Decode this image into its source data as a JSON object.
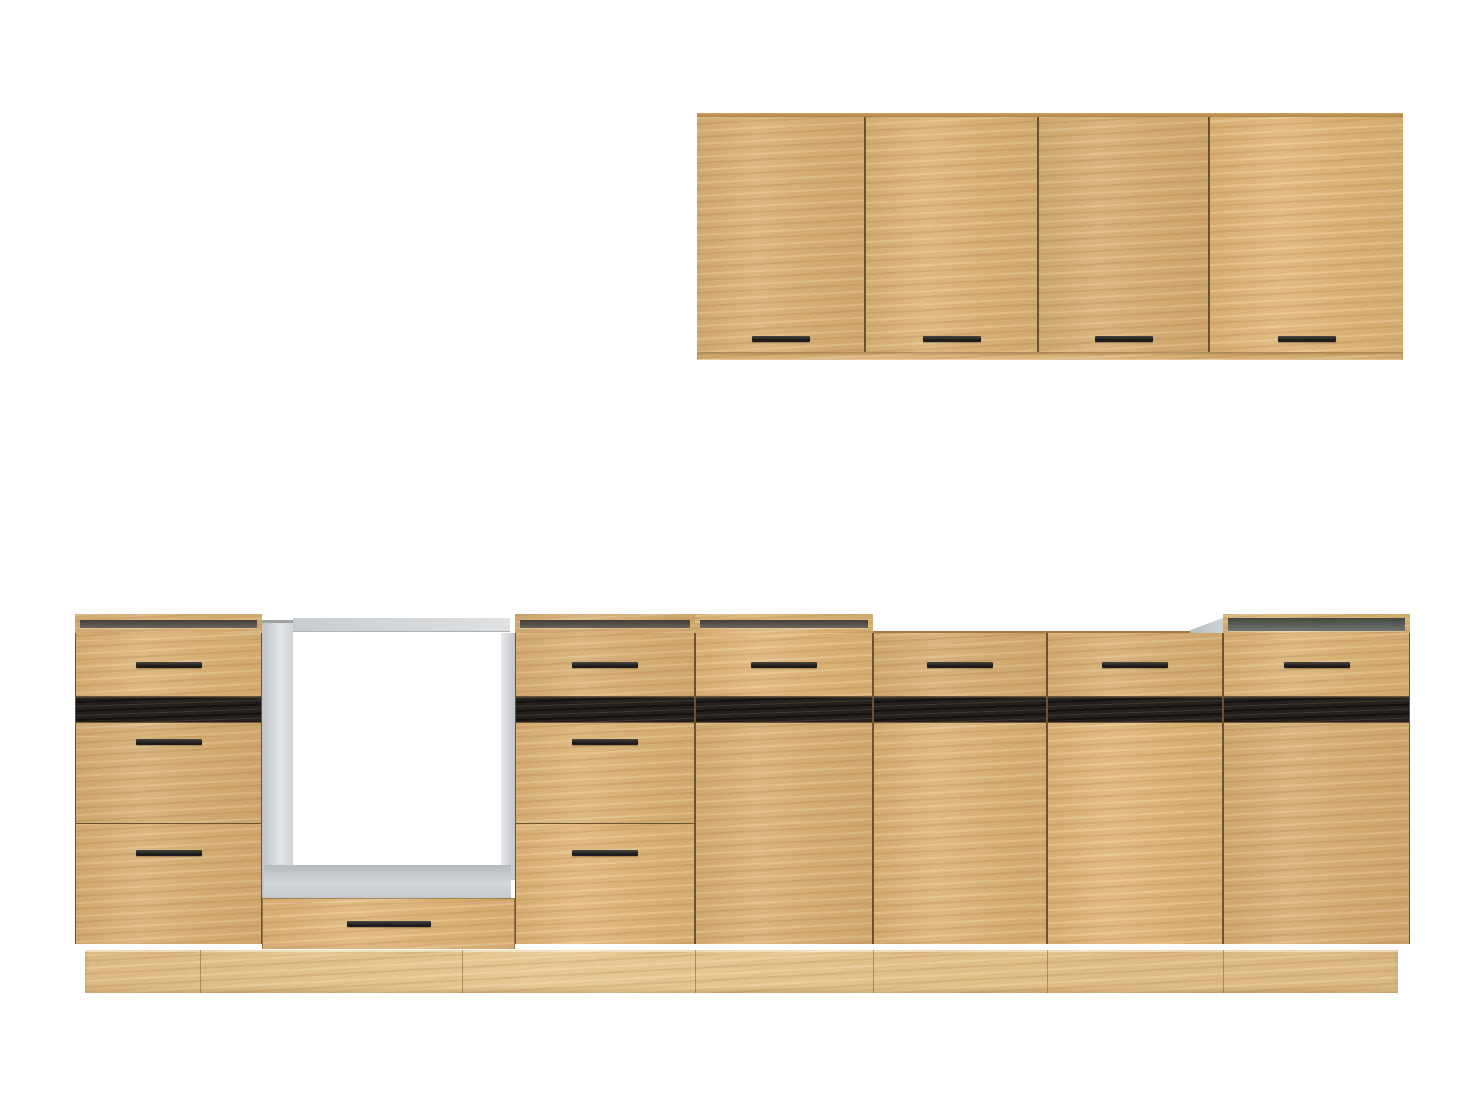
{
  "meta": {
    "type": "product-photo",
    "subject": "Modular kitchen cabinet set in natural oak with black accent strips and black bar handles, shown without countertop on a plain white background",
    "background_color": "#ffffff"
  },
  "colors": {
    "background": "#ffffff",
    "wood": "#d8b177",
    "wood_light": "#e8cb97",
    "wood_dark": "#b78d55",
    "gap": "#6b5330",
    "accent_strip": "#24211d",
    "handle": "#1d1c1a",
    "carcass_grey": "#d6d8da",
    "carcass_grey_dark": "#a7abae",
    "interior_slot": "#433e36",
    "plinth": "#debe8a"
  },
  "wall_cabinet": {
    "door_count": 4,
    "handle_style": "black horizontal bar near bottom center of each door"
  },
  "base_run": {
    "units": [
      {
        "name": "drawer-unit-left",
        "open_top": true,
        "fronts": [
          "drawer",
          "accent-strip",
          "drawer",
          "drawer"
        ],
        "handles": 3
      },
      {
        "name": "oven-housing",
        "open_top": true,
        "fronts": [
          "open cavity",
          "bottom drawer"
        ],
        "handles": 1
      },
      {
        "name": "drawer-unit-middle",
        "open_top": true,
        "fronts": [
          "drawer",
          "accent-strip",
          "drawer",
          "drawer"
        ],
        "handles": 3
      },
      {
        "name": "door-unit-1",
        "open_top": true,
        "fronts": [
          "drawer",
          "accent-strip",
          "door"
        ],
        "handles": 1
      },
      {
        "name": "door-unit-2",
        "open_top": false,
        "fronts": [
          "drawer",
          "accent-strip",
          "door"
        ],
        "handles": 1
      },
      {
        "name": "door-unit-3",
        "open_top": false,
        "fronts": [
          "drawer",
          "accent-strip",
          "door"
        ],
        "handles": 1
      },
      {
        "name": "sink-unit-right",
        "open_top": true,
        "fronts": [
          "drawer",
          "accent-strip",
          "door"
        ],
        "handles": 1
      }
    ],
    "plinth": "continuous recessed oak plinth"
  }
}
